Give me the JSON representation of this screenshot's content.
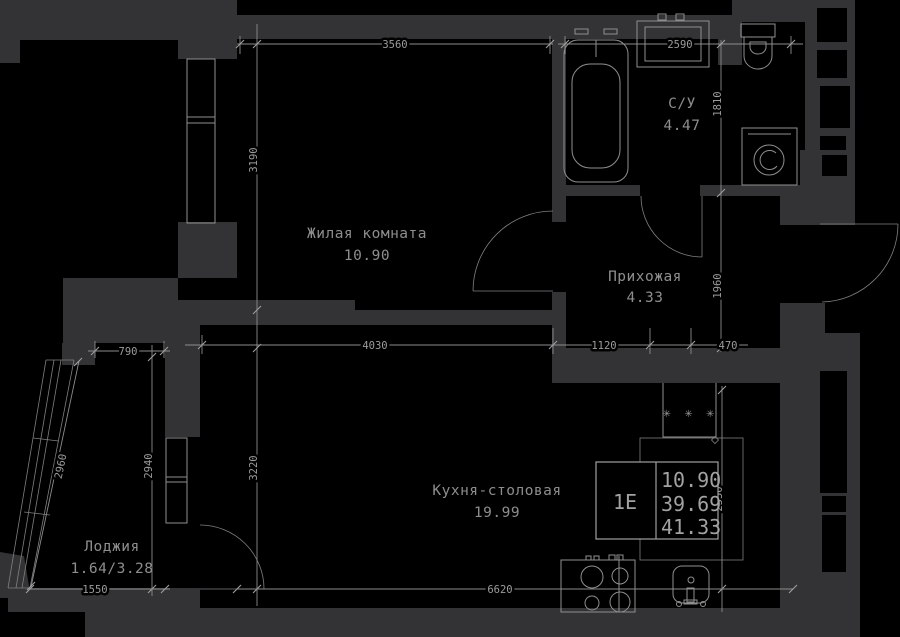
{
  "plan_title": "apartment-floor-plan",
  "rooms": [
    {
      "name": "Жилая комната",
      "area": "10.90"
    },
    {
      "name": "С/У",
      "area": "4.47"
    },
    {
      "name": "Прихожая",
      "area": "4.33"
    },
    {
      "name": "Кухня-столовая",
      "area": "19.99"
    },
    {
      "name": "Лоджия",
      "area": "1.64/3.28"
    }
  ],
  "legend": {
    "unit": "1Е",
    "values": [
      "10.90",
      "39.69",
      "41.33"
    ]
  },
  "dims": {
    "living_width": "3560",
    "bath_width": "2590",
    "living_height": "3190",
    "bath_height": "1810",
    "hall_height": "1960",
    "kitchen_top_a": "4030",
    "kitchen_top_b": "1120",
    "kitchen_top_c": "470",
    "loggia_top": "790",
    "loggia_diag": "2960",
    "loggia_height": "2940",
    "kitchen_height": "3220",
    "kitchen_right": "2550",
    "loggia_bottom": "1550",
    "kitchen_bottom": "6620"
  },
  "symbols": {
    "fridge_marks": "✳ ✳ ✳"
  },
  "colors": {
    "background": "#000000",
    "wall": "#333335",
    "line": "#8f8f8f",
    "text": "#9c9c9c"
  }
}
